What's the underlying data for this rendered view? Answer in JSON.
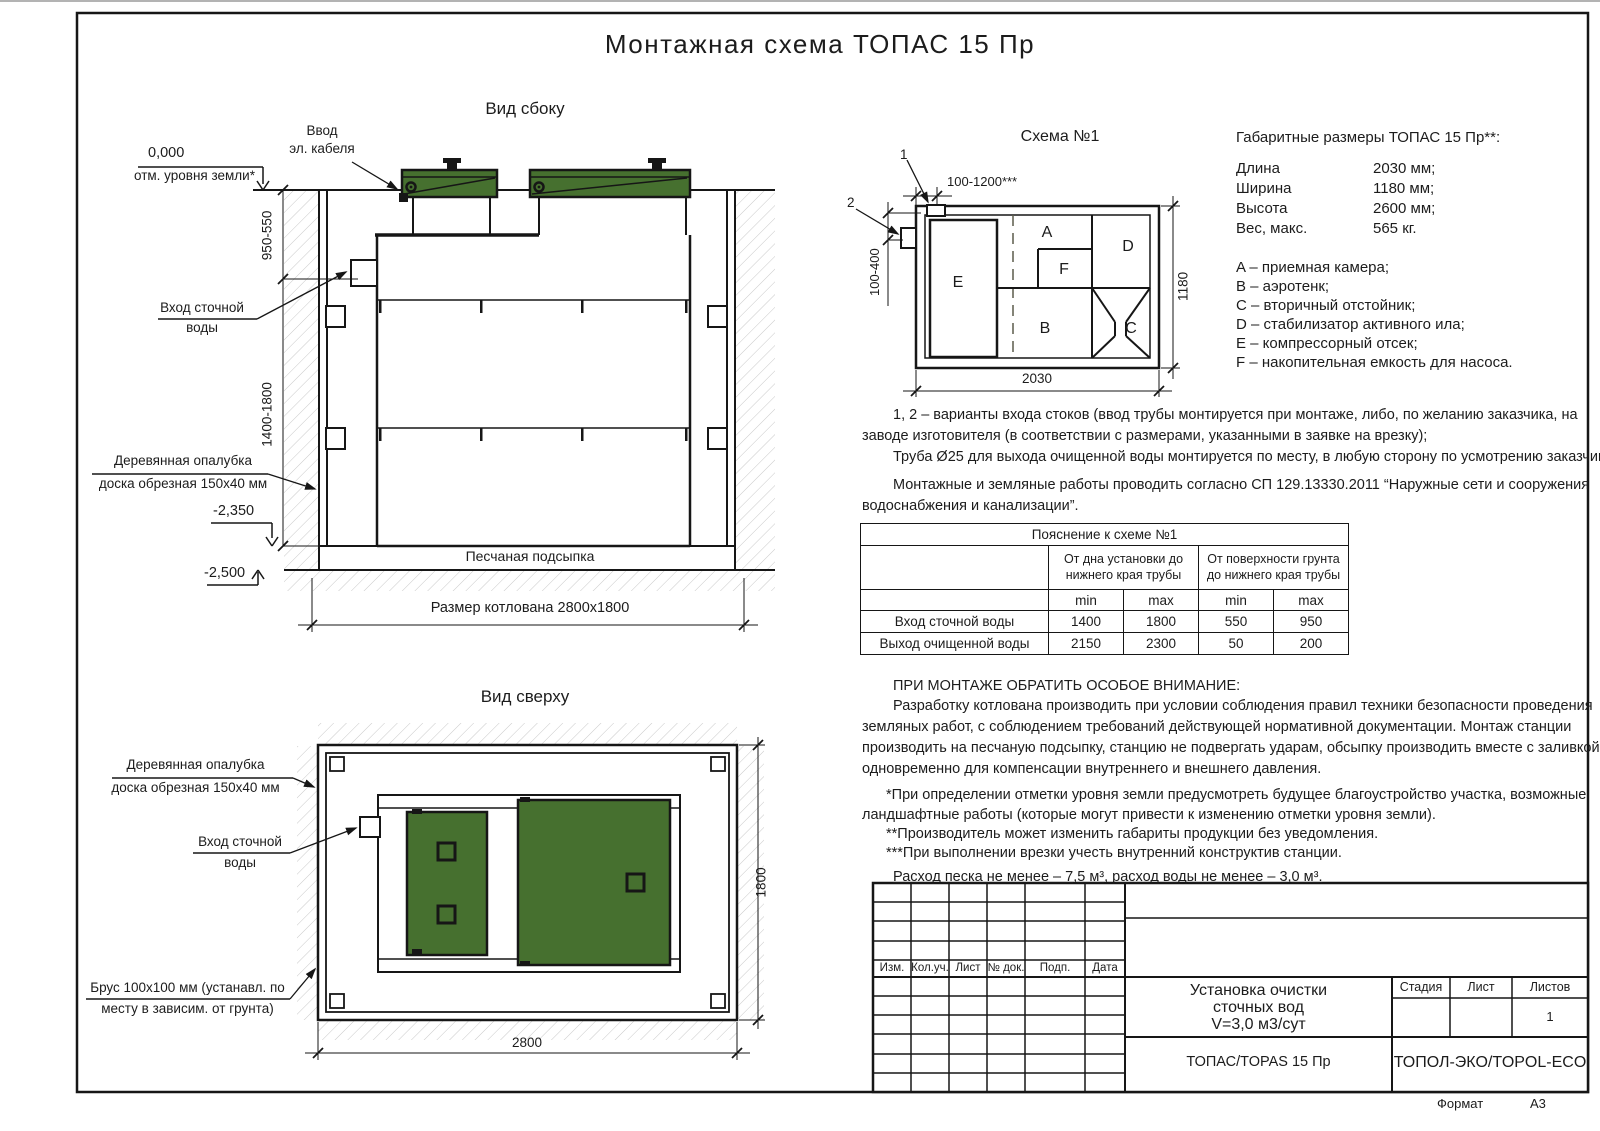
{
  "title": "Монтажная схема ТОПАС 15 Пр",
  "side_view": {
    "label": "Вид сбоку",
    "ground_level": "0,000",
    "ground_level_note": "отм. уровня земли*",
    "cable_entry_line1": "Ввод",
    "cable_entry_line2": "эл. кабеля",
    "dim_upper": "950-550",
    "dim_lower": "1400-1800",
    "inlet_line1": "Вход сточной",
    "inlet_line2": "воды",
    "formwork_line1": "Деревянная опалубка",
    "formwork_line2": "доска обрезная 150х40 мм",
    "level_2350": "-2,350",
    "level_2500": "-2,500",
    "sand_label": "Песчаная подсыпка",
    "pit_size": "Размер котлована 2800х1800"
  },
  "scheme": {
    "label": "Схема №1",
    "callout_1": "1",
    "callout_2": "2",
    "dim_top": "100-1200***",
    "dim_left": "100-400",
    "dim_width": "2030",
    "dim_height": "1180",
    "compartments": [
      "A",
      "B",
      "C",
      "D",
      "E",
      "F"
    ]
  },
  "dimensions_block": {
    "title": "Габаритные размеры ТОПАС 15 Пр**:",
    "rows": [
      {
        "label": "Длина",
        "value": "2030 мм;"
      },
      {
        "label": "Ширина",
        "value": "1180 мм;"
      },
      {
        "label": "Высота",
        "value": "2600 мм;"
      },
      {
        "label": "Вес, макс.",
        "value": "565 кг."
      }
    ],
    "legend": [
      "A – приемная камера;",
      "B – аэротенк;",
      "C – вторичный отстойник;",
      "D – стабилизатор активного ила;",
      "E – компрессорный отсек;",
      "F – накопительная емкость для насоса."
    ]
  },
  "notes": {
    "para1_lines": [
      "1, 2 – варианты входа  стоков (ввод трубы монтируется при монтаже, либо, по желанию заказчика, на",
      "заводе изготовителя (в соответствии с размерами, указанными в заявке на врезку);",
      "Труба Ø25 для выхода очищенной воды монтируется по месту, в любую сторону по усмотрению заказчика."
    ],
    "para2_lines": [
      "Монтажные и земляные работы проводить согласно СП 129.13330.2011 “Наружные сети и сооружения",
      "водоснабжения и канализации”."
    ]
  },
  "table": {
    "title": "Пояснение к схеме №1",
    "col_group1": "От дна установки до нижнего края трубы",
    "col_group2": "От поверхности грунта до нижнего края трубы",
    "min": "min",
    "max": "max",
    "rows": [
      {
        "label": "Вход сточной воды",
        "v1": "1400",
        "v2": "1800",
        "v3": "550",
        "v4": "950"
      },
      {
        "label": "Выход очищенной воды",
        "v1": "2150",
        "v2": "2300",
        "v3": "50",
        "v4": "200"
      }
    ]
  },
  "attention": {
    "title": "ПРИ МОНТАЖЕ ОБРАТИТЬ ОСОБОЕ ВНИМАНИЕ:",
    "body_lines": [
      "Разработку котлована производить при условии соблюдения правил техники безопасности проведения",
      "земляных работ, с соблюдением требований действующей нормативной документации. Монтаж станции",
      "производить на песчаную подсыпку, станцию не подвергать ударам, обсыпку производить вместе с заливкой",
      "одновременно для компенсации внутреннего и внешнего давления."
    ],
    "note1_lines": [
      "*При определении отметки уровня земли предусмотреть будущее благоустройство участка, возможные",
      "ландшафтные работы (которые могут привести к изменению отметки уровня земли)."
    ],
    "note2": "**Производитель может изменить габариты продукции без уведомления.",
    "note3": "***При выполнении врезки учесть внутренний конструктив станции.",
    "consumption": "Расход песка не менее – 7,5 м³, расход воды не менее – 3,0 м³."
  },
  "top_view": {
    "label": "Вид сверху",
    "formwork_line1": "Деревянная опалубка",
    "formwork_line2": "доска обрезная 150х40 мм",
    "inlet_line1": "Вход сточной",
    "inlet_line2": "воды",
    "beam_line1": "Брус 100х100 мм (устанавл. по",
    "beam_line2": "месту в зависим. от грунта)",
    "dim_width": "2800",
    "dim_height": "1800"
  },
  "stamp": {
    "header_cols": [
      "Изм.",
      "Кол.уч.",
      "Лист",
      "№ док.",
      "Подп.",
      "Дата"
    ],
    "doc_title_line1": "Установка очистки",
    "doc_title_line2": "сточных вод",
    "doc_title_line3": "V=3,0 м3/сут",
    "product": "ТОПАС/TOPAS 15 Пр",
    "stage": "Стадия",
    "sheet": "Лист",
    "sheets": "Листов",
    "sheets_value": "1",
    "company": "ТОПОЛ-ЭКО/TOPOL-ECO",
    "format_label": "Формат",
    "format_value": "А3"
  },
  "colors": {
    "lid_green": "#46702f",
    "line": "#161616"
  }
}
